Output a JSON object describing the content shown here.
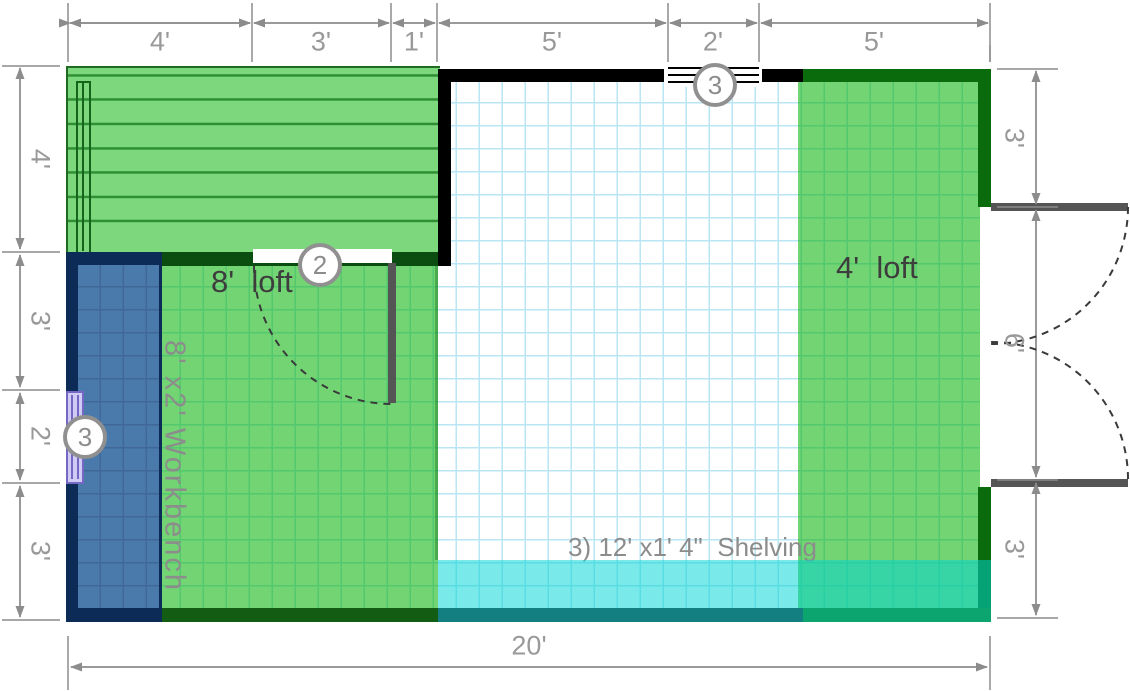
{
  "plan_title": "shed-floor-plan",
  "dimensions": {
    "top": [
      "4'",
      "3'",
      "1'",
      "5'",
      "2'",
      "5'"
    ],
    "left": [
      "4'",
      "3'",
      "2'",
      "3'"
    ],
    "right": [
      "3'",
      "6'",
      "3'"
    ],
    "bottom": [
      "20'"
    ]
  },
  "labels": {
    "loft8": "8'  loft",
    "loft4": "4'  loft",
    "workbench": "8' x2' Workbench",
    "shelving": "3) 12' x1' 4\"  Shelving"
  },
  "badges": {
    "interior_door": "2",
    "top_window": "3",
    "left_window": "3"
  },
  "colors": {
    "loft_plank_green": "#7dd87d",
    "overlay_green": "rgba(0,176,0,0.55)",
    "overlay_cyan": "rgba(0,212,212,0.52)",
    "wall_black": "#000000",
    "wall_dark_green": "#0a6b0d",
    "interior_wall_green": "#0b4d11",
    "shelf_border_teal": "#147f81",
    "workbench_navy": "#0d2b57",
    "workbench_fill": "#4a79ab",
    "window_purple": "#7468c4",
    "door_gray": "#555555",
    "dimension_gray": "#8c8c8c",
    "grid_blue": "#b9e5f4"
  }
}
